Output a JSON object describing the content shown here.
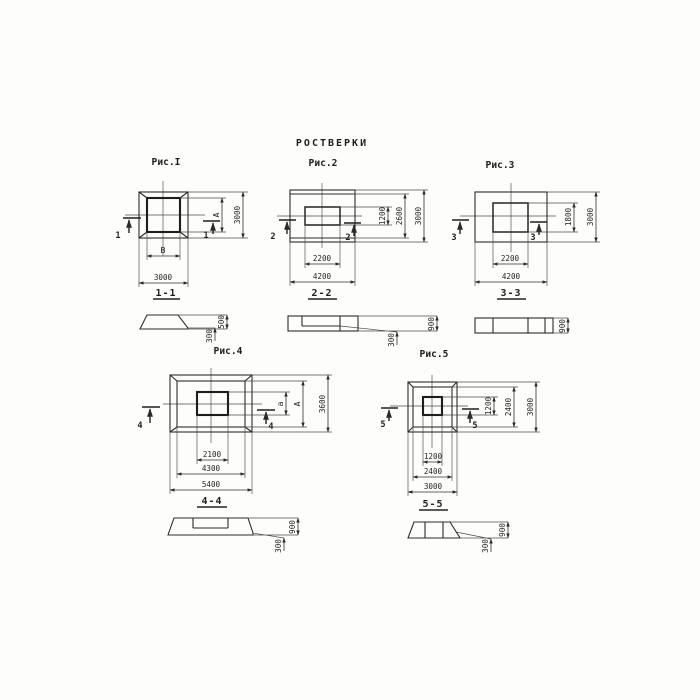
{
  "title": "РОСТВЕРКИ",
  "figures": {
    "fig1": {
      "label": "Рис.I",
      "cut_mark": "1",
      "section_label": "1-1",
      "plan_dims": {
        "inner_width": "В",
        "inner_height": "А",
        "outer_width": "3000",
        "outer_height": "3000"
      },
      "section_dims": {
        "total_height": "500",
        "edge_height": "300"
      }
    },
    "fig2": {
      "label": "Рис.2",
      "cut_mark": "2",
      "section_label": "2-2",
      "plan_dims": {
        "inner_width": "2200",
        "inner_height": "1200",
        "mid_height": "2600",
        "outer_width": "4200",
        "outer_height": "3000"
      },
      "section_dims": {
        "total_height": "900",
        "edge_height": "300"
      }
    },
    "fig3": {
      "label": "Рис.3",
      "cut_mark": "3",
      "section_label": "3-3",
      "plan_dims": {
        "inner_width": "2200",
        "inner_height": "1800",
        "outer_width": "4200",
        "outer_height": "3000"
      },
      "section_dims": {
        "total_height": "900"
      }
    },
    "fig4": {
      "label": "Рис.4",
      "cut_mark": "4",
      "section_label": "4-4",
      "plan_dims": {
        "inner_width": "2100",
        "mid_width": "4300",
        "outer_width": "5400",
        "inner_height": "а",
        "mid_height": "А",
        "outer_height": "3600"
      },
      "section_dims": {
        "total_height": "900",
        "edge_height": "300"
      }
    },
    "fig5": {
      "label": "Рис.5",
      "cut_mark": "5",
      "section_label": "5-5",
      "plan_dims": {
        "inner_width": "1200",
        "mid_width": "2400",
        "outer_width": "3000",
        "inner_height": "1200",
        "mid_height": "2400",
        "outer_height": "3000"
      },
      "section_dims": {
        "total_height": "900",
        "edge_height": "300"
      }
    }
  }
}
